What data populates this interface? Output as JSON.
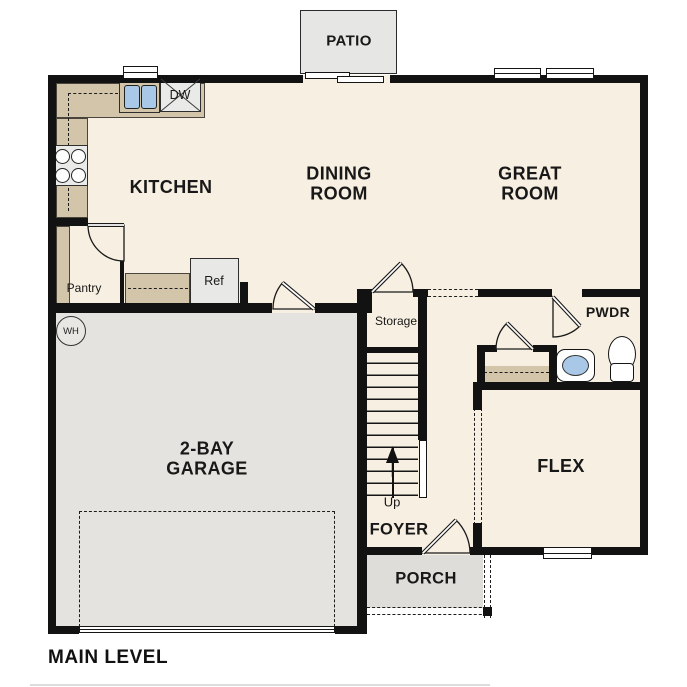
{
  "title": "MAIN LEVEL",
  "colors": {
    "floor": "#f7efe1",
    "counter": "#d2c5a9",
    "garage": "#e5e3e0",
    "patio": "#e6e6e4",
    "porch": "#dfddd9",
    "fixture_blue": "#a9c7e7",
    "wall": "#121212"
  },
  "rooms": {
    "patio": "PATIO",
    "kitchen": "KITCHEN",
    "dining_room": "DINING\nROOM",
    "great_room": "GREAT\nROOM",
    "pantry": "Pantry",
    "storage": "Storage",
    "powder": "PWDR",
    "flex": "FLEX",
    "garage": "2-BAY\nGARAGE",
    "foyer": "FOYER",
    "porch": "PORCH"
  },
  "fixtures": {
    "refrigerator": "Ref",
    "dishwasher": "DW",
    "water_heater": "WH",
    "stair_direction": "Up"
  }
}
